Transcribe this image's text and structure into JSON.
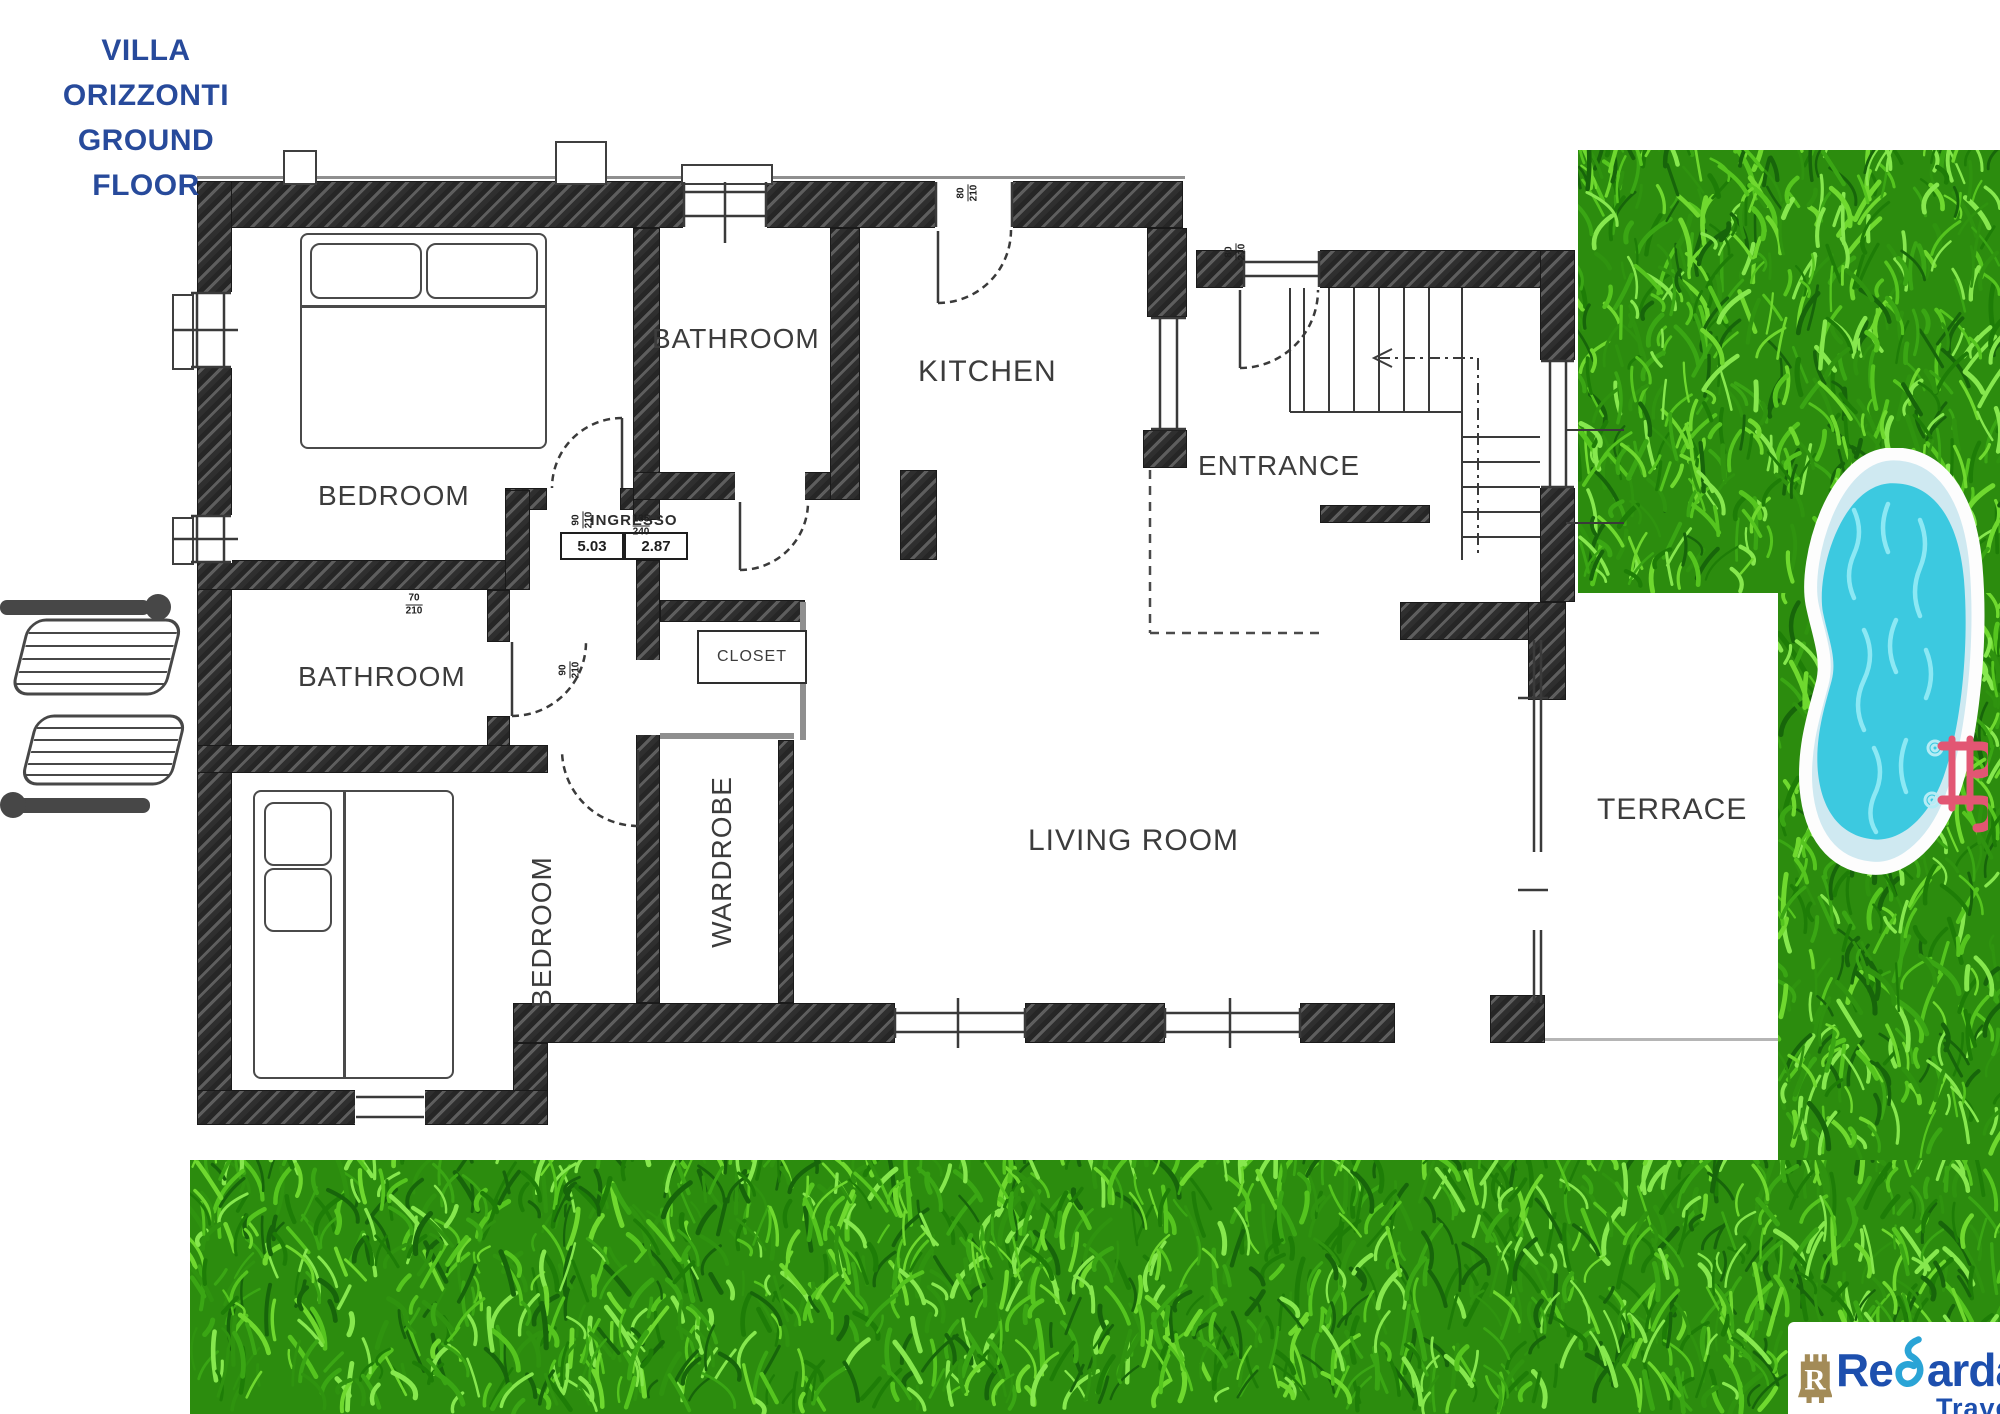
{
  "title": {
    "line1": "VILLA ORIZZONTI",
    "line2": "GROUND FLOOR"
  },
  "rooms": {
    "bedroom_top": "BEDROOM",
    "bathroom_top": "BATHROOM",
    "kitchen": "KITCHEN",
    "entrance": "ENTRANCE",
    "bathroom_left": "BATHROOM",
    "closet": "CLOSET",
    "wardrobe": "WARDROBE",
    "bedroom_bottom": "BEDROOM",
    "living_room": "LIVING ROOM",
    "terrace": "TERRACE"
  },
  "annotations": {
    "hall": {
      "label": "INGRESSO",
      "width_m": "5.03",
      "depth_m": "2.87"
    },
    "door_markers": [
      {
        "w": "90",
        "h": "210"
      },
      {
        "w": "135",
        "h": "240"
      },
      {
        "w": "70",
        "h": "210"
      },
      {
        "w": "90",
        "h": "210"
      },
      {
        "w": "80",
        "h": "210"
      },
      {
        "w": "80",
        "h": "210"
      }
    ]
  },
  "logo": {
    "prefix": "Re",
    "r_letter": "R",
    "rest": "arda",
    "subtitle": "Travel"
  },
  "colors": {
    "title_blue": "#274a9b",
    "logo_blue": "#1d4fae",
    "logo_gold": "#a38b57",
    "logo_cyan": "#2aa4d6",
    "pool_water": "#3cc9e0",
    "grass_green": "#2c8c0e",
    "ladder_pink": "#e25673",
    "wall_dark": "#2f2f2f"
  }
}
